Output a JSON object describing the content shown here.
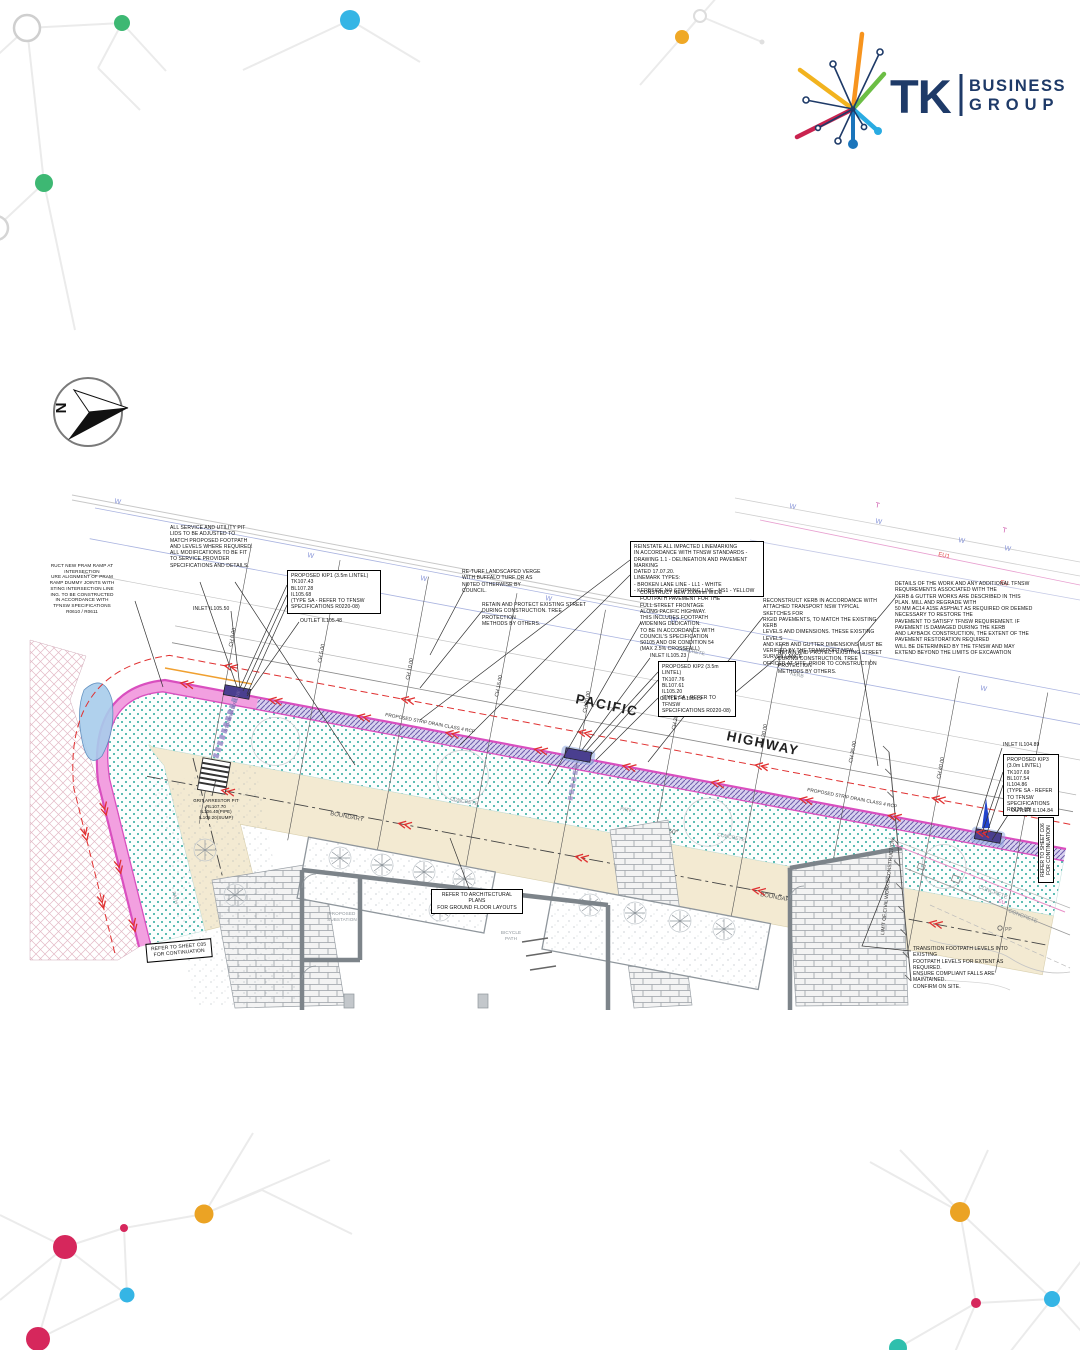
{
  "brand": {
    "tk": "TK",
    "business": "BUSINESS",
    "group": "GROUP",
    "colors": {
      "navy": "#1E3A68",
      "orange": "#F7941E",
      "yellow": "#F2B31F",
      "green": "#6CBE45",
      "crimson": "#C9234F",
      "cyan": "#29ABE2",
      "blue": "#1B75BB"
    }
  },
  "compass": {
    "north": "N"
  },
  "street": {
    "pacific": "PACIFIC",
    "highway": "HIGHWAY"
  },
  "chainages": [
    "CH 0.00",
    "CH 5.00",
    "CH 10.00",
    "CH 15.00",
    "CH 20.00",
    "CH 25.00",
    "CH 30.00",
    "CH 35.00",
    "CH 40.00",
    "CH 45.18"
  ],
  "levels": {
    "inlet1": "INLET IL105.50",
    "outlet1": "OUTLET IL105.48",
    "inlet2": "INLET IL105.23",
    "outlet2": "OUTLET IL105.19",
    "inlet3": "INLET IL104.89",
    "outlet3": "OUTLET IL104.84"
  },
  "notes": {
    "pram_ramp": "RUCT NEW PRAM RAMP AT\nINTERSECTION\nURE ALIGNMENT OF PRAM\nRAMP DUMMY JOINTS WITH\nSTING INTERSECTION LINE\nING. TO BE CONSTRUCTED\nIN ACCORDANCE WITH\nTFNSW SPECIFICATIONS\nR0610 / R0611",
    "service_pits": "ALL SERVICE AND UTILITY PIT\nLIDS TO BE ADJUSTED TO\nMATCH PROPOSED FOOTPATH\nAND LEVELS WHERE REQUIRED.\nALL MODIFICATIONS TO BE FIT\nTO SERVICE PROVIDER\nSPECIFICATIONS AND DETAILS.",
    "kip1": "PROPOSED KIP1 (3.5m LINTEL)\nTK107.43\nBL107.28\nIL105.68\n(TYPE SA - REFER TO TFNSW\nSPECIFICATIONS R0220-08)",
    "kip2": "PROPOSED KIP2 (3.5m LINTEL)\nTK107.76\nBL107.61\nIL105.20\n(TYPE SA - REFER TO TFNSW\nSPECIFICATIONS R0220-08)",
    "kip3": "PROPOSED KIP3\n(3.0m LINTEL)\nTK107.69\nBL107.54\nIL104.86\n(TYPE SA - REFER\nTO TFNSW\nSPECIFICATIONS\nR0220-08)",
    "returf": "RE-TURF LANDSCAPED VERGE\nWITH BUFFALO TURF OR AS\nNOTED OTHERWISE BY\nCOUNCIL.",
    "retain_trees": "RETAIN AND PROTECT EXISTING STREET\nDURING CONSTRUCTION. TREE PROTECTION\nMETHODS BY OTHERS.",
    "linemarking": "REINSTATE ALL IMPACTED LINEMARKING\nIN ACCORDANCE WITH TFNSW STANDARDS -\nDRAWING 1.1 - DELINEATION AND PAVEMENT MARKING\nDATED 17.07.20.\nLINEMARK TYPES:\n- BROKEN LANE LINE - LL1 - WHITE\n- KERBSIDE NO STOPPING LINE - NS1 - YELLOW",
    "footpath": "CONSTRUCT NEW 2000mm WIDE\nFOOTPATH PAVEMENT FOR THE\nFULL STREET FRONTAGE\nALONG PACIFIC HIGHWAY.\nTHIS INCLUDES FOOTPATH\nWIDENING DEDICATION.\nTO BE IN ACCORDANCE WITH\nCOUNCIL'S SPECIFICATION\nS0105 AND OR CONDITION 54\n(MAX 2.5% CROSSFALL)",
    "kerb_reconstruct": "RECONSTRUCT KERB IN ACCORDANCE WITH\nATTACHED TRANSPORT NSW TYPICAL SKETCHES FOR\nRIGID PAVEMENTS, TO MATCH THE EXISTING KERB\nLEVELS AND DIMENSIONS. THESE EXISTING LEVELS\nAND KERB AND GUTTER DIMENSIONS MUST BE\nVERIFIED BY THE TRANSPORT NSW SURVEILLANCE\nOFFICER AT SITE, PRIOR TO CONSTRUCTION",
    "tfnsw_details": "DETAILS OF THE WORK AND ANY ADDITIONAL TFNSW\nREQUIREMENTS ASSOCIATED WITH THE\nKERB & GUTTER WORKS ARE DESCRIBED IN THIS\nPLAN. MILL AND REGRADE WITH\n50 MM AC14 A15E ASPHALT AS REQUIRED OR DEEMED\nNECESSARY TO RESTORE THE\nPAVEMENT TO SATISFY TFNSW REQUIREMENT. IF\nPAVEMENT IS DAMAGED DURING THE KERB\nAND LAYBACK CONSTRUCTION, THE EXTENT OF THE\nPAVEMENT RESTORATION REQUIRED\nWILL BE DETERMINED BY THE TFNSW AND MAY\nEXTEND BEYOND THE LIMITS OF EXCAVATION",
    "transition": "TRANSITION FOOTPATH LEVELS INTO EXISTING\nFOOTPATH LEVELS FOR EXTENT AS REQUIRED.\nENSURE COMPLIANT FALLS ARE MAINTAINED.\nCONFIRM ON SITE.",
    "sheet_c05": "REFER TO SHEET C05\nFOR CONTINUATION",
    "sheet_c06": "REFER TO SHEET C06\nFOR CONTINUATION",
    "arch_plans": "REFER TO ARCHITECTURAL PLANS\nFOR GROUND FLOOR LAYOUTS",
    "grit_pit": "GRIT ARRESTOR PIT\nRL107.70\nIL106.40(PIPE)\nIL106.20(SUMP)"
  },
  "labels": {
    "boundary": "BOUNDARY",
    "concrete": "CONCRETE",
    "path": "PATH",
    "kerb": "KERB",
    "strip_drain": "PROPOSED STRIP DRAIN CLASS 4 RCP",
    "limit": "LIMIT OF CIVIL WORKS/CONSTRUCTION",
    "stormwater": "STORMWATER LINE",
    "bearing": "185° 50' 50\"",
    "distance": "47.395",
    "w": "W",
    "t": "T",
    "eu": "EU",
    "eu1": "EU1",
    "pp": "PP",
    "bicycle": "BICYCLE\nPATH",
    "substation": "PROPOSED\nSUBSTATION"
  },
  "plan_colors": {
    "kerb_magenta": "#D94FBF",
    "drain_purple": "#6F5FAE",
    "verge_teal": "#2BA89D",
    "footpath_beige": "#F3EAD2",
    "red_dash": "#E03131",
    "water_blue": "#93A2DC"
  }
}
